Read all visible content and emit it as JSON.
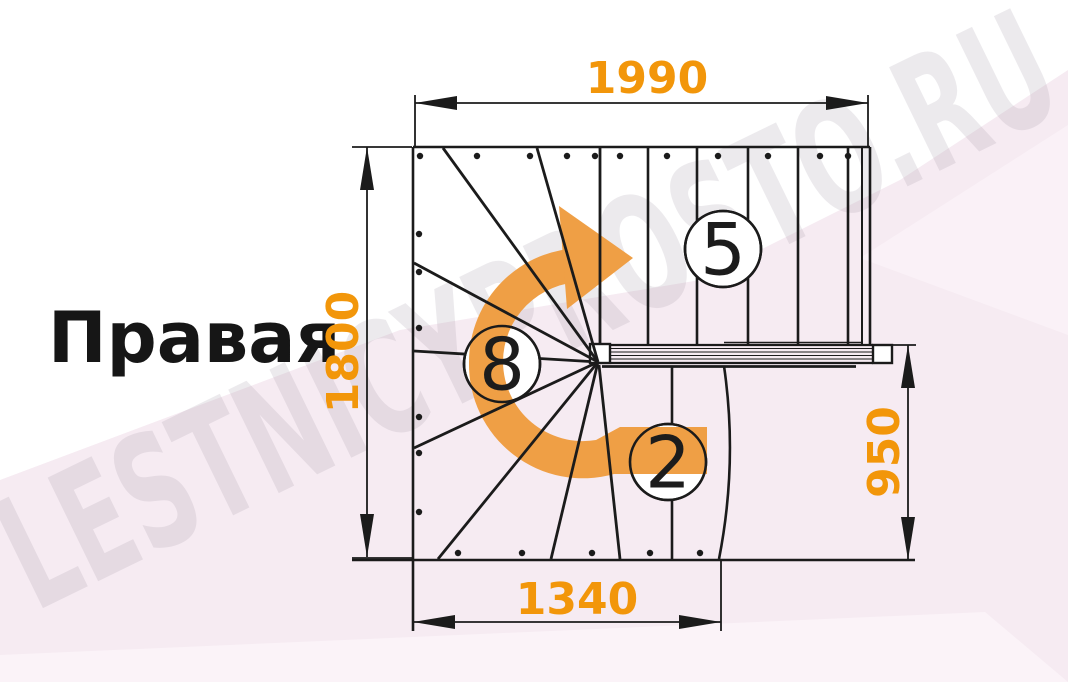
{
  "page": {
    "title_label": "Правая"
  },
  "watermark": {
    "text": "LESTNICYPROSTO.RU"
  },
  "dimensions": {
    "top": "1990",
    "left": "1800",
    "right": "950",
    "bottom": "1340"
  },
  "steps": {
    "upper_flight": "5",
    "winder": "8",
    "lower_flight": "2"
  },
  "colors": {
    "dimension_text": "#F2960A",
    "arrow_orange": "#EF9F45",
    "line_black": "#1B1B1B",
    "background_pink": "#F6EBF2",
    "background_pink_light": "#FBF3F8",
    "watermark_gray": "#8F8596",
    "circle_fill": "#FFFFFF"
  }
}
